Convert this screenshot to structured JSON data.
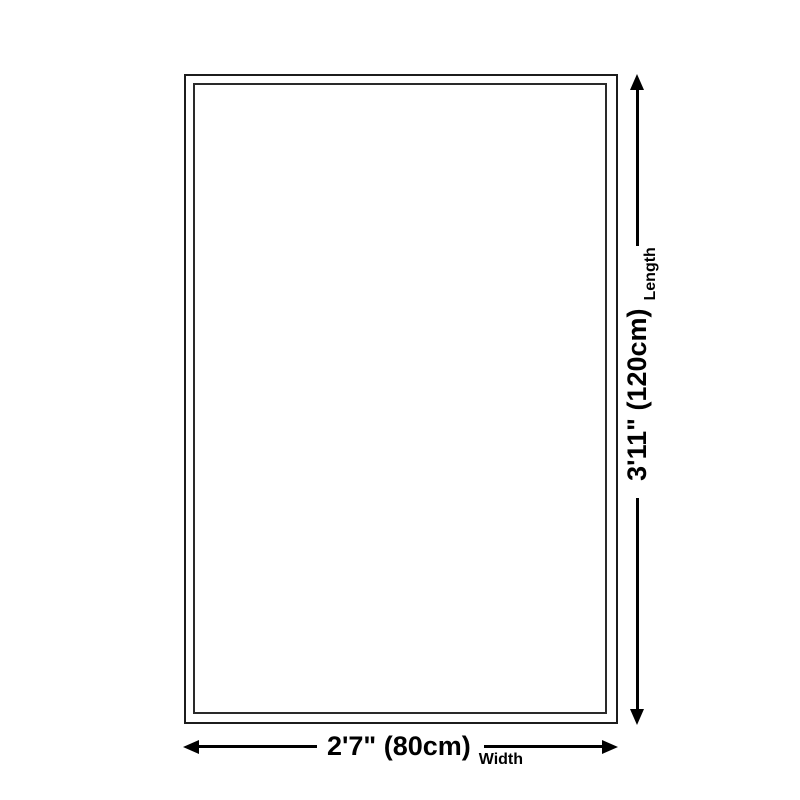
{
  "diagram": {
    "type": "product-dimension-diagram",
    "length": {
      "value": "3'11\" (120cm)",
      "axis": "Length"
    },
    "width": {
      "value": "2'7\" (80cm)",
      "axis": "Width"
    },
    "colors": {
      "background": "#ffffff",
      "outline": "#1c1c1c",
      "dimension_lines": "#000000",
      "text": "#000000"
    }
  }
}
